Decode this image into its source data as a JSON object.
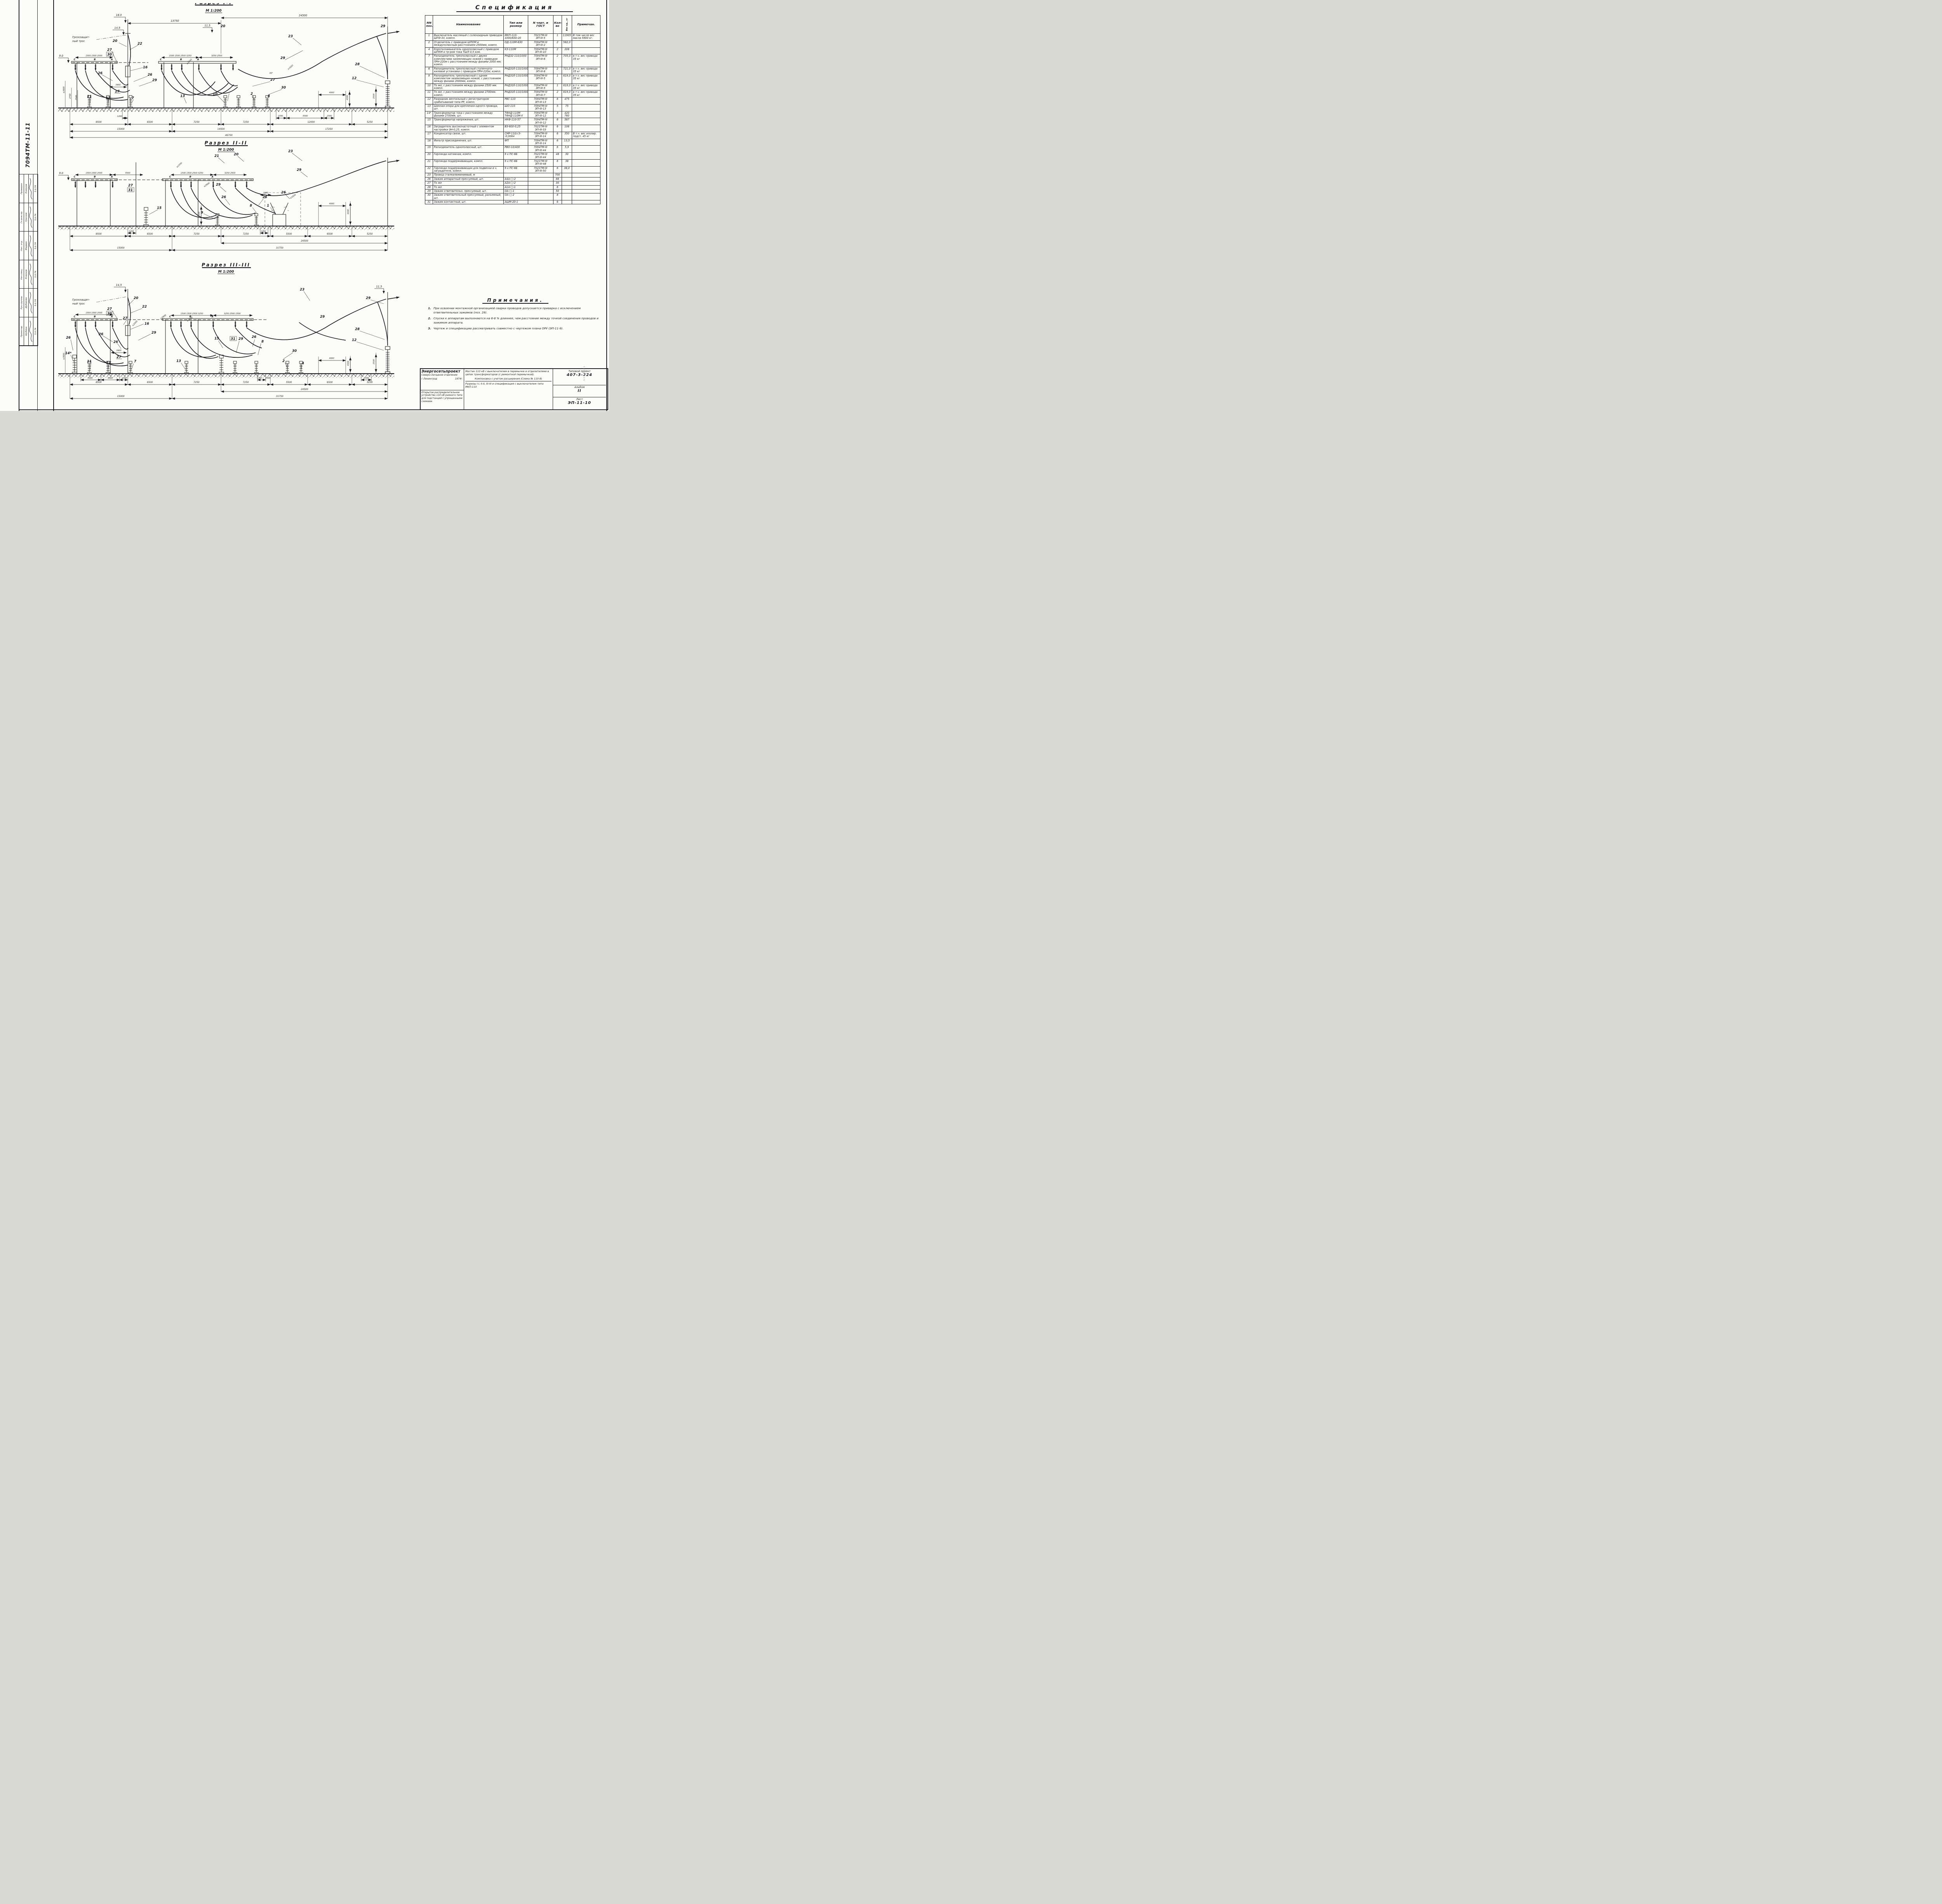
{
  "doc": {
    "number_vertical": "7094ТМ-11-11",
    "watermark": "NORMACS"
  },
  "stamp": {
    "people": [
      {
        "role": "Проверил",
        "name": "Есионов",
        "date": "5.II.74"
      },
      {
        "role": "Гл.инж.пр.",
        "name": "Гроснов",
        "date": "5.II.74"
      },
      {
        "role": "Нач. отд.",
        "name": "Фадвин",
        "date": "5.II.74"
      },
      {
        "role": "Нач.секц.",
        "name": "Есионов",
        "date": "5.II.74"
      },
      {
        "role": "Рук.группы",
        "name": "Дубовчик",
        "date": "5.II.74"
      },
      {
        "role": "Проектир.",
        "name": "Шубина",
        "date": "5.II.74"
      }
    ]
  },
  "sections": {
    "s1": {
      "title": "Разрез I-I",
      "scale": "М 1:200",
      "tros1": "Грозозащит-",
      "tros2": "ный трос",
      "h_mast": "18.0",
      "h_wire": "14.5",
      "h_mid": "11,5",
      "c20b": "20",
      "h_left": "9.0",
      "span1": "13750",
      "span2": "24500",
      "pdL": "1500 1500 2500",
      "pdM": "1500 1500 2500 3250",
      "pdM2": "3250 2500",
      "phC": "С",
      "phB": "В",
      "phA": "А",
      "c20": "20",
      "c22": "22",
      "c27": "27",
      "c30": "30",
      "c16": "16",
      "c26a": "26",
      "c26b": "26",
      "c26c": "26",
      "c29a": "29",
      "c27b": "27",
      "c27c": "27",
      "c11": "11",
      "c17": "17",
      "c7": "7",
      "c2": "2",
      "c13": "13",
      "c10": "10",
      "c23": "23",
      "c29b": "29",
      "c29c": "29",
      "c28": "28",
      "c12": "12",
      "c4": "4",
      "c30b": "30",
      "d3900": "3900",
      "a30": "30°",
      "ge1650a": "≥1650",
      "ge1650b": "≥1650",
      "ge3600": "≥3600",
      "d2760": "2760",
      "d2500L": "2500",
      "d1200": "1200",
      "d1550": "1550",
      "d5500": "5500",
      "d1500": "1500",
      "d4000": "4000",
      "d4300": "4300",
      "d2500R": "2500",
      "ch1": [
        "8500",
        "6500",
        "7250",
        "7250",
        "12000",
        "5250"
      ],
      "ch2": [
        "15000",
        "14500",
        "17250"
      ],
      "ch3": "46750"
    },
    "s2": {
      "title": "Разрез II-II",
      "scale": "М 1:200",
      "h_left": "9.0",
      "pdL": "1500 1500 2500",
      "d4500": "4500",
      "pdM": "1500 1500 2500 3250",
      "pdM2": "3250 2500",
      "phC": "С",
      "phB": "В",
      "phA": "А",
      "c21": "21",
      "c20": "20",
      "c23": "23",
      "c27": "27",
      "c31": "31",
      "c29a": "29",
      "c29b": "29",
      "c26a": "26",
      "c26b": "26",
      "c26c": "26",
      "c15": "15",
      "c9": "9",
      "c8": "8",
      "c1": "1",
      "ge1550": "≥1550",
      "ge2900": "≥2900",
      "ge1650": "≥1650",
      "d1550": "1550",
      "d4000": "4000",
      "d4300": "4300",
      "d2500": "2500",
      "d1200a": "1200",
      "d1200b": "1200",
      "ch1": [
        "8500",
        "6500",
        "7250",
        "7250",
        "5500",
        "6500",
        "5250"
      ],
      "d24500": "24500",
      "d15000": "15000",
      "d31750": "31750"
    },
    "s3": {
      "title": "Разрез III-III",
      "scale": "М 1:200",
      "tros1": "Грозозащит-",
      "tros2": "ный трос",
      "h_mast": "14,5",
      "h_right": "11,5",
      "pdL": "1500 1500 2500",
      "pdM": "1500 1500 2500 3250",
      "pdM2": "3250 2500 1500",
      "phC": "С",
      "phB": "В",
      "phA": "А",
      "c20": "20",
      "c22": "22",
      "c27a": "27",
      "c30a": "30",
      "c27b": "27",
      "c27c": "27",
      "c16": "16",
      "c26a": "26",
      "c26b": "26",
      "c26c": "26",
      "c26d": "26",
      "c29a": "29",
      "c29b": "29",
      "c29c": "29",
      "c29d": "29",
      "c14": "14*",
      "c11": "11",
      "c17": "17",
      "c7": "7",
      "c13": "13",
      "c15": "15",
      "c31": "31",
      "c8": "8",
      "c2": "2",
      "c4": "4",
      "c23": "23",
      "c28": "28",
      "c12": "12",
      "c30b": "30",
      "d3900": "3900",
      "ge2900a": "≥2900",
      "ge2900b": "≥2900",
      "ge2500": "≥2500",
      "ge3600": "≥3600",
      "d3000": "3000",
      "d4000": "4000",
      "d1200": "1200",
      "d1200b": "1200",
      "d1500b": "1500",
      "d1500c": "1500",
      "d4000r": "4000",
      "d4300": "4300",
      "d2500r": "2500",
      "ch1": [
        "8500",
        "6500",
        "7250",
        "7250",
        "5500",
        "6500",
        "5250"
      ],
      "d24500": "24500",
      "d15000": "15000",
      "d31750": "31750"
    }
  },
  "spec": {
    "title": "Спецификация",
    "headers": [
      "NN\nпоз.",
      "Наименование",
      "Тип или\nразмер",
      "N черт. и\nГОСТ",
      "Кол-\nво",
      "Вес ед., кг",
      "Примечан."
    ],
    "rows": [
      {
        "pos": "1",
        "name": "Выключатель масляный с соленоидным приводом ШПЭ-33, компл.",
        "type": "МКП-110-\n1000/630-20",
        "ref": "7021ТМ-III\nЭП-III-5",
        "qty": "1",
        "wt": "11905",
        "note": "В том числе вес масла 5900 кг."
      },
      {
        "pos": "2",
        "name": "Отделитель с приводом ШПОМ и междуполюсным расстоянием 2500мм, компл.",
        "type": "ОД-110М-630",
        "ref": "7094ТМ-III\nЭП-III-2",
        "qty": "2",
        "wt": "582,0",
        "note": ""
      },
      {
        "pos": "4",
        "name": "Короткозамыкатель однополюсный с приводом ШПКМ и тр-ром тока ТШЛ 0,5 ком.",
        "type": "КЗ-110М",
        "ref": "7094ТМ-III\nЭП-III-10",
        "qty": "2",
        "wt": "208",
        "note": ""
      },
      {
        "pos": "7",
        "name": "Разъединитель трехполюсный с двумя комплектами заземляющих ножей с приводом ПРН-220м с расстоянием между фазами 2000 мм;  компл.",
        "type": "РНДЗ2-110/1000",
        "ref": "7094ТМ-III\nЭП-III-6",
        "qty": "2",
        "wt": "705,0",
        "note": "в т.ч. вес привода 35 кг"
      },
      {
        "pos": "8",
        "name": "Разъединитель трехполюсный ступенчато-килевой установки с приводом ПРН-220м;  компл.",
        "type": "РНДЗ1б-110/1000",
        "ref": "7094ТМ-III\nЭП-III-8",
        "qty": "2",
        "wt": "721,0",
        "note": "в т.ч. вес привода 35 кг"
      },
      {
        "pos": "9",
        "name": "Разъединитель трехполюсный с одним комплектом заземляющих ножей, с расстоянием между фазами 2000мм, компл.",
        "type": "РНДЗ1б-110/1000",
        "ref": "7094ТМ-III\nЭП-III-5",
        "qty": "1",
        "wt": "619,0",
        "note": "в т.ч. вес привода 35 кг"
      },
      {
        "pos": "10",
        "name": "То же, с расстоянием между фазами 2500 мм.  компл.",
        "type": "РНДЗ1б-110/1000",
        "ref": "7094ТМ-III\nЭП-III-5",
        "qty": "1",
        "wt": "619,0",
        "note": "в т.ч. вес привода 35 кг"
      },
      {
        "pos": "11",
        "name": "То же, с расстоянием между фазами 2700мм.  компл.",
        "type": "РНДЗ1б-110/1000",
        "ref": "7094ТМ-III\nЭП-III-7",
        "qty": "2",
        "wt": "619,0",
        "note": "в т.ч. вес привода 35 кг"
      },
      {
        "pos": "12",
        "name": "Разрядник вентильный с регистратором срабатываний типа РР, компл.",
        "type": "РВС-110",
        "ref": "7094ТМ-III\nЭП-III-13",
        "qty": "6",
        "wt": "475",
        "note": ""
      },
      {
        "pos": "13",
        "name": "Шинная опора для крепления одного провода,  шт.",
        "type": "ШО-110",
        "ref": "7094ТМ-III\nЭП-III-13",
        "qty": "5",
        "wt": "75",
        "note": ""
      },
      {
        "pos": "14*",
        "name": "Трансформатор тока с расстоянием между фазами 2700мм,  шт.",
        "type": "ТФНД-110М\nТФНД-110М-II",
        "ref": "7094ТМ-III\nЭП-III-12",
        "qty": "3",
        "wt": "420\n760",
        "note": ""
      },
      {
        "pos": "15",
        "name": "Трансформатор напряжения,  шт.",
        "type": "НКФ-110-57",
        "ref": "7094ТМ-III\nЭП-III-12",
        "qty": "6",
        "wt": "587",
        "note": ""
      },
      {
        "pos": "16",
        "name": "Заградитель высокочастотный с элементом настройки ЭН-0,25, компл.",
        "type": "ВЗ-600-0,25",
        "ref": "7021ТМ-III\nЭП-III-33",
        "qty": "6",
        "wt": "106",
        "note": ""
      },
      {
        "pos": "17",
        "name": "Конденсатор связи,  шт.",
        "type": "СМР-110/√3-\n-0,0064",
        "ref": "7094ТМ-III\nЭП-III-14",
        "qty": "6",
        "wt": "350",
        "note": "В т.ч. вес изолир. подст. 45 кг"
      },
      {
        "pos": "18",
        "name": "Фильтр присоединения,  шт.",
        "type": "ФП",
        "ref": "7094ТМ-III\nЭП-III-14",
        "qty": "6",
        "wt": "13,5",
        "note": ""
      },
      {
        "pos": "19",
        "name": "Разъединитель однополюсный, шт.",
        "type": "РВО-10/400",
        "ref": "7094ТМ-III\nЭП-III-44",
        "qty": "6",
        "wt": "5,9",
        "note": ""
      },
      {
        "pos": "20",
        "name": "Гирлянда натяжная,  компл.",
        "type": "9 х ПС-6Б",
        "ref": "7021ТМ-III\nЭП-III-44",
        "qty": "48",
        "wt": "30",
        "note": ""
      },
      {
        "pos": "21",
        "name": "Гирлянда поддерживающая, компл.",
        "type": "9 х ПС-6Б",
        "ref": "7021ТМ-III\nЭП-III-48",
        "qty": "6",
        "wt": "38",
        "note": ""
      },
      {
        "pos": "22",
        "name": "Гирлянда поддерживающая для подвески в ч. заградителя, компл.",
        "type": "9 х ПС-6Б",
        "ref": "7021ТМ-III\nЭП-III-50",
        "qty": "6",
        "wt": "38,0",
        "note": ""
      },
      {
        "pos": "23",
        "name": "Провод сталеалюминиевый,  м",
        "type": "",
        "ref": "",
        "qty": "700",
        "wt": "",
        "note": ""
      },
      {
        "pos": "26",
        "name": "Зажим аппаратный прессуемый, шт.",
        "type": "А4А-□-2",
        "ref": "",
        "qty": "66",
        "wt": "",
        "note": ""
      },
      {
        "pos": "27",
        "name": "То же",
        "type": "А2А-□-2",
        "ref": "",
        "qty": "30",
        "wt": "",
        "note": ""
      },
      {
        "pos": "28",
        "name": "То же",
        "type": "А1А-□-1",
        "ref": "",
        "qty": "6",
        "wt": "",
        "note": ""
      },
      {
        "pos": "29",
        "name": "Зажим ответвительн. прессуемый, шт.",
        "type": "ОА-□-1",
        "ref": "",
        "qty": "50",
        "wt": "",
        "note": ""
      },
      {
        "pos": "30",
        "name": "Зажим ответвительный прессуемый,  разъемный,  шт.",
        "type": "ОА-□-2",
        "ref": "",
        "qty": "8",
        "wt": "",
        "note": ""
      },
      {
        "pos": "31",
        "name": "Зажим контактный,  шт.",
        "type": "АШМ-20-1",
        "ref": "",
        "qty": "6",
        "wt": "",
        "note": ""
      }
    ]
  },
  "notes": {
    "title": "Примечания.",
    "items": [
      {
        "n": "1.",
        "text": "При освоении монтажной организацией сварки проводов допускается приварка с исключением ответвительных зажимов (поз. 29)."
      },
      {
        "n": "2.",
        "text": "Спуски к аппаратам выполняются на 6-8 % длиннее, чем расстояние между точкой соединения проводов и зажимом аппарата."
      },
      {
        "n": "3.",
        "text": "Чертеж и спецификацию рассматривать совместно с чертежом плана ОРУ (ЭП-11-9)."
      }
    ]
  },
  "titleblock": {
    "org_name": "Энергосетьпроект",
    "org_branch": "Северо-Западное отделение",
    "org_city": "г.Ленинград",
    "org_year": "1974г.",
    "org_object": "Открытое распределительное устройство 110 кВ рамного типа для подстанций с упрощенными схемами.",
    "subject1": "Мостик 110 кВ с выключателем в перемычке и отделителями в цепях трансформаторов (с ремонтной перемычкой).",
    "subject2": "Компоновка с учетом расширения (Схема № 110-8)",
    "subject3": "Разрезы I-I, II-II, III-III и спецификация с выключателем типа МКП-110",
    "proj_label": "Типовой проект",
    "proj_num": "407-3-224",
    "album_label": "Альбом",
    "album_num": "II",
    "sheet_label": "Лист",
    "sheet_num": "ЭП-11-10"
  }
}
